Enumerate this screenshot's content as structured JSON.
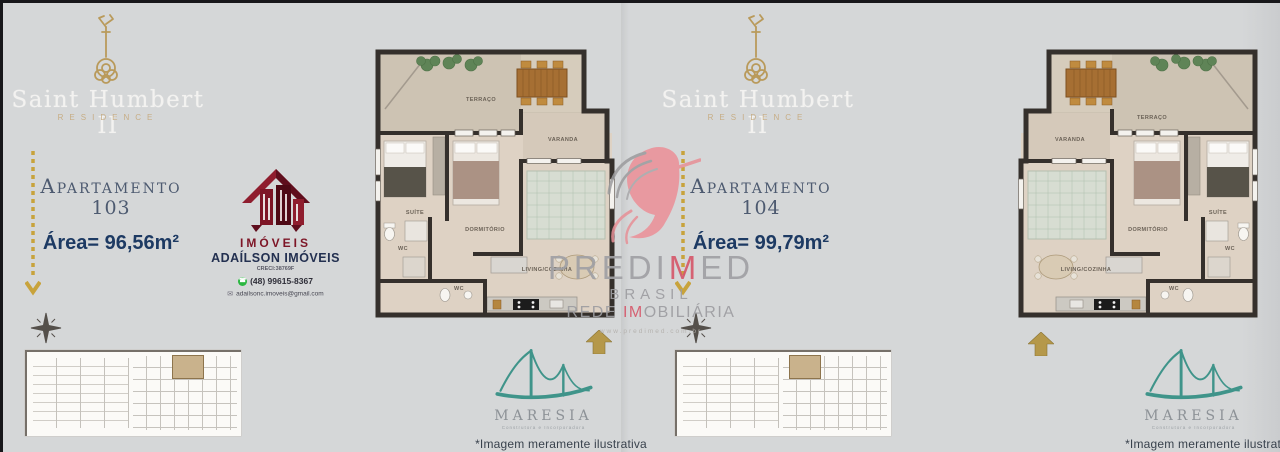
{
  "left_panel": {
    "title": "Saint Humbert II",
    "subtitle": "RESIDENCE",
    "apartment_label": "Apartamento",
    "apartment_number": "103",
    "area": "Área= 96,56m²",
    "agency": {
      "logo_caption": "IMÓVEIS",
      "name": "ADAÍLSON IMÓVEIS",
      "creci": "CRECI:38769F",
      "phone": "(48) 99615-8367",
      "email": "adailsonc.imoveis@gmail.com"
    },
    "disclaimer": "*Imagem meramente ilustrativa"
  },
  "right_panel": {
    "title": "Saint Humbert II",
    "subtitle": "RESIDENCE",
    "apartment_label": "Apartamento",
    "apartment_number": "104",
    "area": "Área= 99,79m²",
    "disclaimer": "*Imagem meramente ilustrativa"
  },
  "rooms": {
    "terraco": "TERRAÇO",
    "varanda": "VARANDA",
    "suite": "SUÍTE",
    "dormitorio": "DORMITÓRIO",
    "living": "LIVING/COZINHA",
    "wc": "WC"
  },
  "watermark": {
    "name_pre": "PREDI",
    "name_accent": "M",
    "name_post": "ED",
    "line2": "BRASIL",
    "line3_pre": "REDE ",
    "line3_accent": "IM",
    "line3_post": "OBILIÁRIA",
    "url": "www.predimed.com.br"
  },
  "maresia": {
    "name": "MARESIA",
    "tagline": "Construtora e Incorporadora"
  },
  "colors": {
    "background": "#d5d7d8",
    "gold": "#c2a35f",
    "navy": "#1d3a63",
    "maroon": "#7d1526",
    "teal": "#3f948a",
    "watermark_red": "#d6596b"
  }
}
